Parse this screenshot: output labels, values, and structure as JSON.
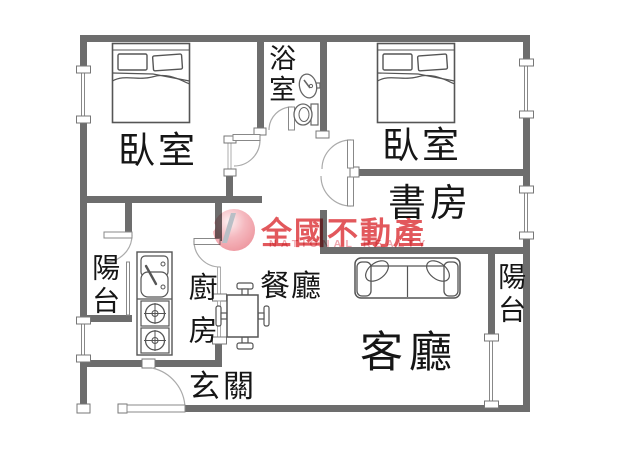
{
  "watermark": {
    "logo_letter": "R",
    "brand": "全國不動產",
    "brand_en": "NATIONAL REALTY"
  },
  "rooms": {
    "bedroom1": {
      "label": "臥室"
    },
    "bathroom": {
      "label": "浴室"
    },
    "bedroom2": {
      "label": "臥室"
    },
    "study": {
      "label": "書房"
    },
    "balcony_left": {
      "label": "陽台"
    },
    "kitchen": {
      "label": "廚房"
    },
    "dining": {
      "label": "餐廳"
    },
    "living": {
      "label": "客廳"
    },
    "entry": {
      "label": "玄關"
    },
    "balcony_right": {
      "label": "陽台"
    }
  },
  "colors": {
    "wall": "#6d6d6d",
    "furniture_line": "#555555",
    "brand_red": "#e04a4e",
    "brand_pink": "#efa6ae"
  }
}
